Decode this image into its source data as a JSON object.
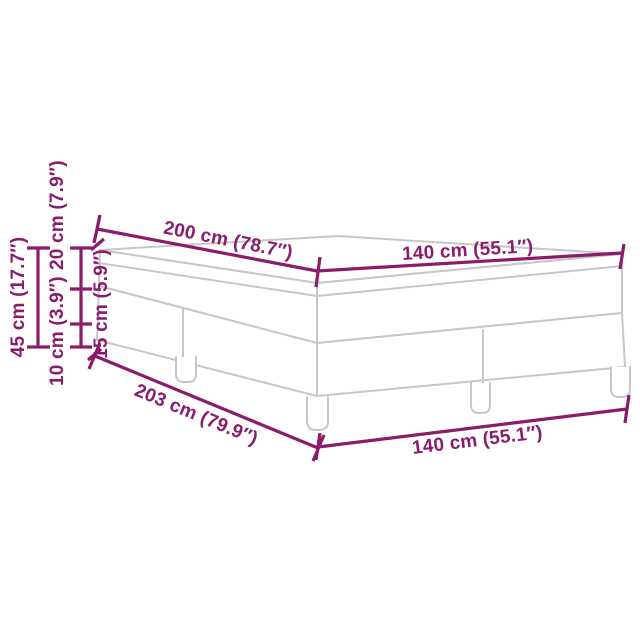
{
  "diagram": {
    "name": "box-spring-bed-dimension-diagram",
    "colors": {
      "dimension": "#8B1B6B",
      "outline": "#C7C7C7",
      "background": "#FFFFFF"
    },
    "labels": {
      "top_length": "200 cm (78.7″)",
      "top_width": "140 cm (55.1″)",
      "total_height": "45 cm (17.7″)",
      "mattress_height": "20 cm (7.9″)",
      "leg_height": "10 cm (3.9″)",
      "frame_height": "15 cm (5.9″)",
      "bottom_length": "203 cm (79.9″)",
      "bottom_width": "140 cm (55.1″)"
    }
  }
}
